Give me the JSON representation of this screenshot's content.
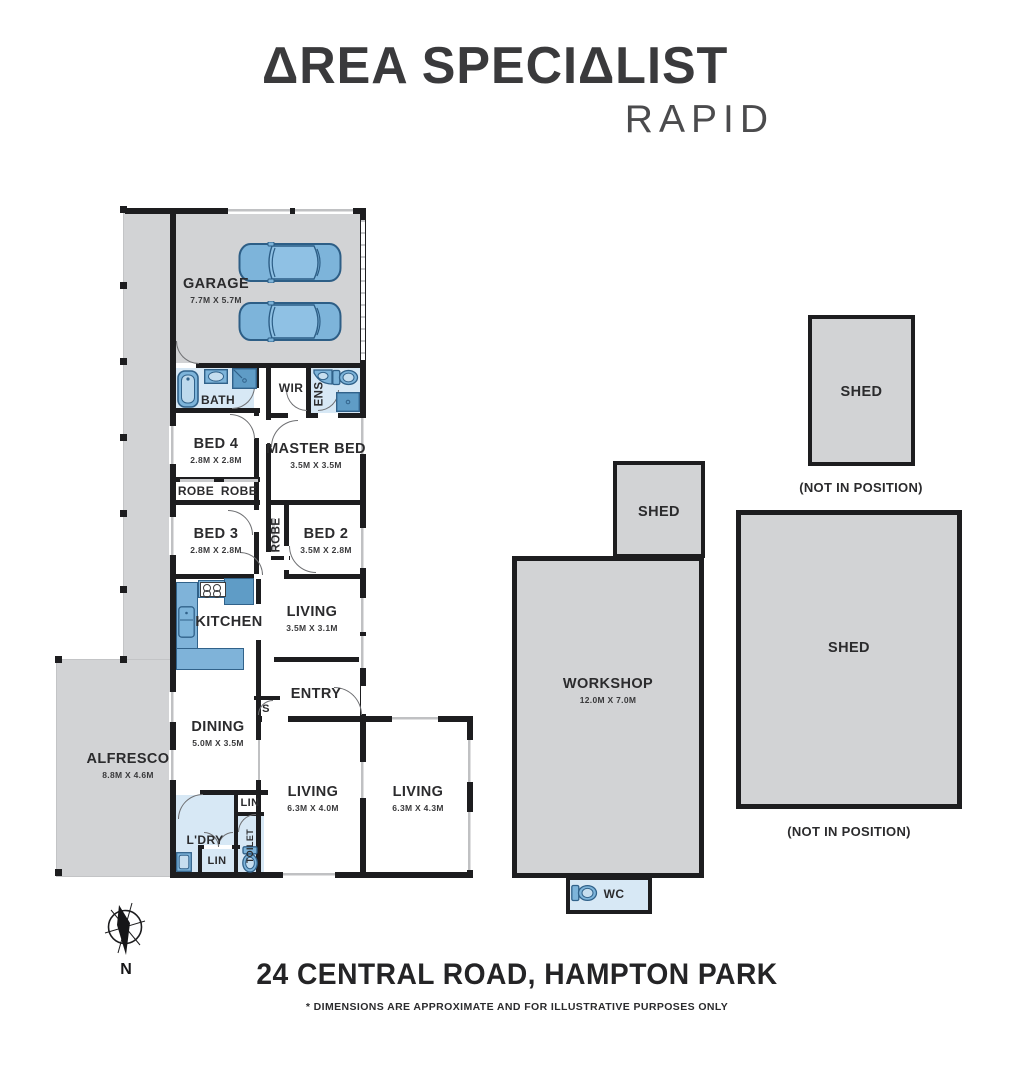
{
  "logo": {
    "brand": "ΔREA SPECIΔLIST",
    "sub": "RAPID"
  },
  "plan": {
    "garage": {
      "label": "GARAGE",
      "dims": "7.7M X 5.7M"
    },
    "bath": {
      "label": "BATH"
    },
    "wir": {
      "label": "WIR"
    },
    "ens": {
      "label": "ENS"
    },
    "bed4": {
      "label": "BED 4",
      "dims": "2.8M X 2.8M"
    },
    "master": {
      "label": "MASTER BED",
      "dims": "3.5M X 3.5M"
    },
    "robe_a": {
      "label": "ROBE"
    },
    "robe_b": {
      "label": "ROBE"
    },
    "robe_c": {
      "label": "ROBE"
    },
    "bed3": {
      "label": "BED 3",
      "dims": "2.8M X 2.8M"
    },
    "bed2": {
      "label": "BED 2",
      "dims": "3.5M X 2.8M"
    },
    "kitchen": {
      "label": "KITCHEN"
    },
    "living1": {
      "label": "LIVING",
      "dims": "3.5M X 3.1M"
    },
    "entry": {
      "label": "ENTRY"
    },
    "store": {
      "label": "S"
    },
    "dining": {
      "label": "DINING",
      "dims": "5.0M X 3.5M"
    },
    "alfresco": {
      "label": "ALFRESCO",
      "dims": "8.8M X 4.6M"
    },
    "ldry": {
      "label": "L'DRY"
    },
    "lin_a": {
      "label": "LIN"
    },
    "lin_b": {
      "label": "LIN"
    },
    "toilet": {
      "label": "TOILET"
    },
    "living2": {
      "label": "LIVING",
      "dims": "6.3M X 4.0M"
    },
    "living3": {
      "label": "LIVING",
      "dims": "6.3M X 4.3M"
    }
  },
  "outbuildings": {
    "shed_small": {
      "label": "SHED"
    },
    "workshop": {
      "label": "WORKSHOP",
      "dims": "12.0M X 7.0M"
    },
    "wc": {
      "label": "WC"
    },
    "shed_ne": {
      "label": "SHED",
      "note": "(NOT IN POSITION)"
    },
    "shed_se": {
      "label": "SHED",
      "note": "(NOT IN POSITION)"
    }
  },
  "compass": {
    "label": "N"
  },
  "footer": {
    "title": "24 CENTRAL ROAD, HAMPTON PARK",
    "disclaimer": "* DIMENSIONS ARE APPROXIMATE AND FOR ILLUSTRATIVE PURPOSES ONLY"
  },
  "colors": {
    "wall": "#1d1d1f",
    "outdoor": "#d2d3d5",
    "wet_room": "#d7e8f5",
    "fixture": "#7fb3d9",
    "fixture_dark": "#5f9cc6",
    "text": "#2b2b2d"
  }
}
